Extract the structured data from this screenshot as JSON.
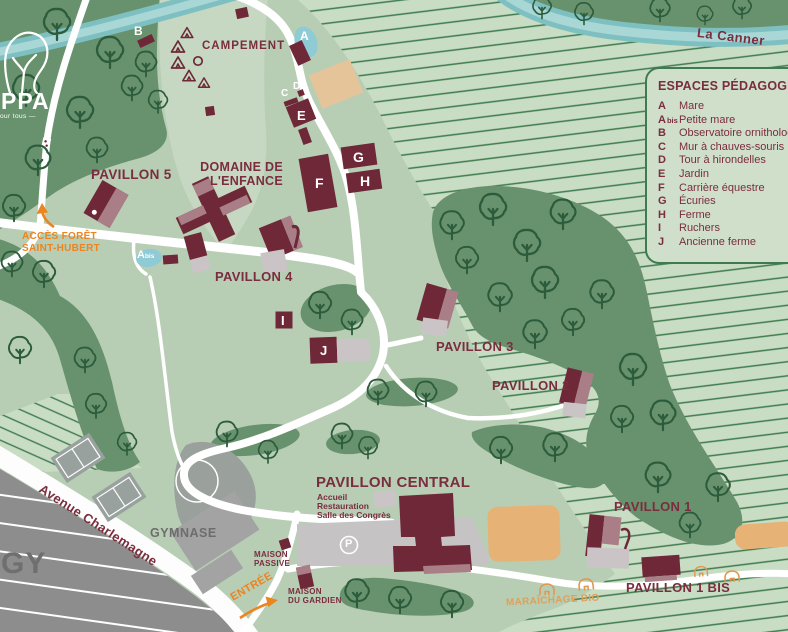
{
  "logo": {
    "brand": "PPA",
    "tagline": "our tous —"
  },
  "legend": {
    "title": "ESPACES PÉDAGOGIQUES",
    "items": [
      {
        "key": "A",
        "suffix": "",
        "label": "Mare"
      },
      {
        "key": "A",
        "suffix": "bis",
        "label": "Petite mare"
      },
      {
        "key": "B",
        "suffix": "",
        "label": "Observatoire ornithologique"
      },
      {
        "key": "C",
        "suffix": "",
        "label": "Mur à chauves-souris"
      },
      {
        "key": "D",
        "suffix": "",
        "label": "Tour à hirondelles"
      },
      {
        "key": "E",
        "suffix": "",
        "label": "Jardin"
      },
      {
        "key": "F",
        "suffix": "",
        "label": "Carrière équestre"
      },
      {
        "key": "G",
        "suffix": "",
        "label": "Écuries"
      },
      {
        "key": "H",
        "suffix": "",
        "label": "Ferme"
      },
      {
        "key": "I",
        "suffix": "",
        "label": "Ruchers"
      },
      {
        "key": "J",
        "suffix": "",
        "label": "Ancienne ferme"
      }
    ]
  },
  "river_label": "La Canner",
  "avenue_label": "Avenue Charlemagne",
  "city_label": "GY",
  "wayfinding": {
    "acces_line1": "ACCÈS FORÊT",
    "acces_line2": "SAINT-HUBERT",
    "entree": "ENTRÉE"
  },
  "places": {
    "campement": "CAMPEMENT",
    "domaine_line1": "DOMAINE DE",
    "domaine_line2": "L'ENFANCE",
    "pavillon5": "PAVILLON 5",
    "pavillon4": "PAVILLON 4",
    "pavillon3": "PAVILLON 3",
    "pavillon2": "PAVILLON 2",
    "pavillon1": "PAVILLON 1",
    "pavillon1bis": "PAVILLON 1 BIS",
    "pavillon_central": "PAVILLON CENTRAL",
    "central_service1": "Accueil",
    "central_service2": "Restauration",
    "central_service3": "Salle des Congrès",
    "gymnase": "GYMNASE",
    "maison_passive_line1": "MAISON",
    "maison_passive_line2": "PASSIVE",
    "maison_gardien_line1": "MAISON",
    "maison_gardien_line2": "DU GARDIEN",
    "maraichage": "MARAÎCHAGE BIO"
  },
  "markers": {
    "a": "A",
    "a_bis": "A",
    "a_bis_suffix": "bis",
    "b": "B",
    "c": "C",
    "d": "D",
    "e": "E",
    "f": "F",
    "g": "G",
    "h": "H",
    "i": "I",
    "j": "J",
    "parking": "P"
  },
  "colors": {
    "forest": "#68926d",
    "lawn": "#b7ceb5",
    "field": "#c9dcc4",
    "stripe": "#3e7b50",
    "river": "#7ec0c2",
    "river_light": "#a9d7d6",
    "building": "#6e2838",
    "roof": "#a97e86",
    "annex": "#cbc4c7",
    "label_maroon": "#7a2d3e",
    "orange": "#ec8420",
    "tan": "#e6b276",
    "pond": "#8ecbd5",
    "urban": "#8d8d8d"
  }
}
